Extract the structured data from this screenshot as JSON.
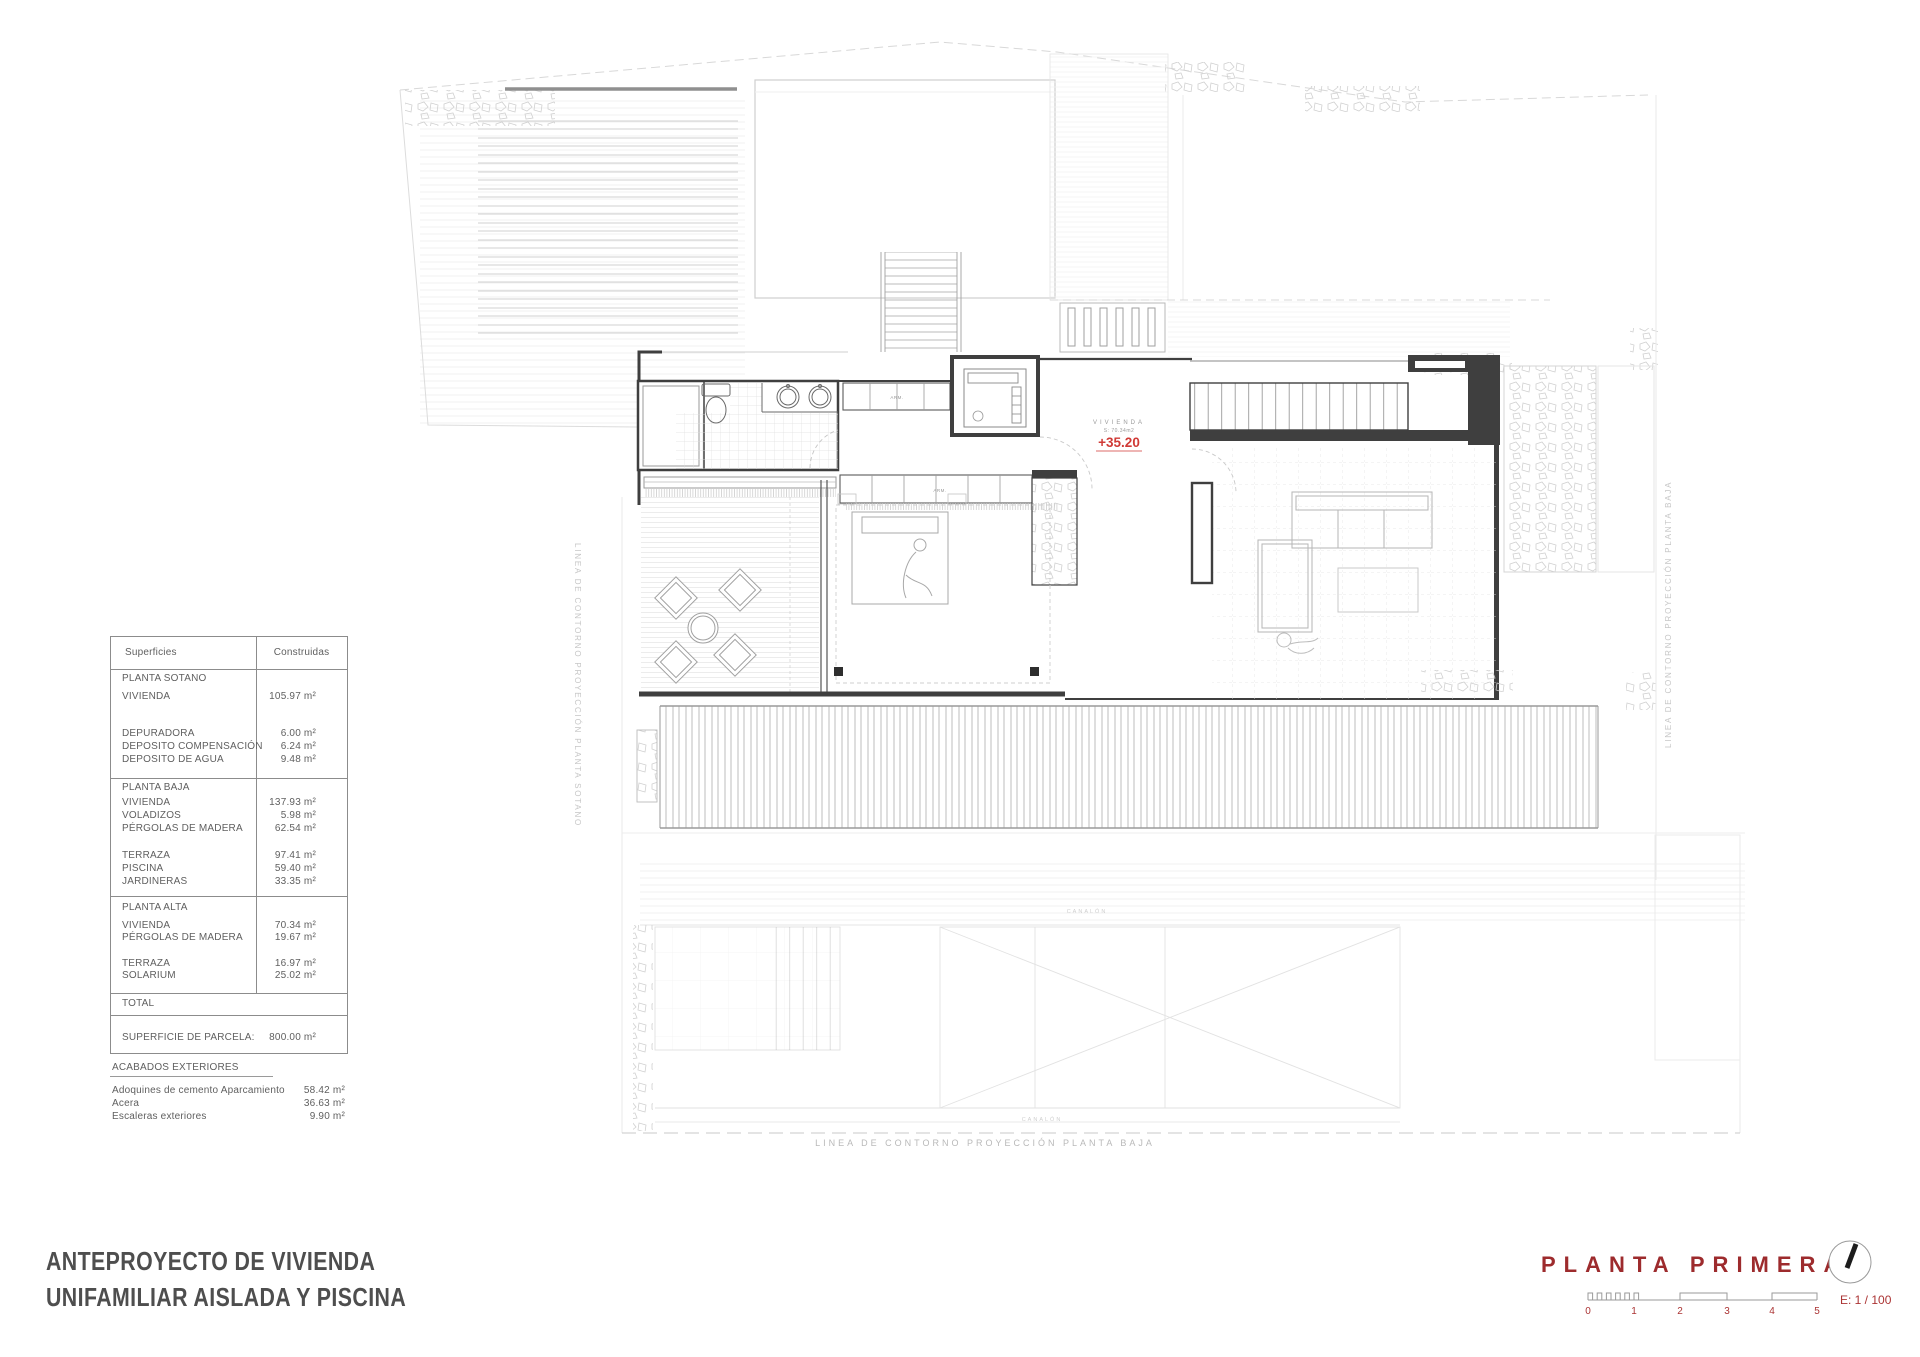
{
  "colors": {
    "accent_red": "#9d2b2d",
    "marker_red": "#d03a36",
    "plan_dark": "#3f3f3f",
    "plan_light": "#d8d8d8"
  },
  "surface_table": {
    "header_col1": "Superficies",
    "header_col2": "Construidas",
    "rows": [
      {
        "label": "PLANTA SOTANO",
        "value": ""
      },
      {
        "label": "VIVIENDA",
        "value": "105.97 m²"
      },
      {
        "label": "DEPURADORA",
        "value": "6.00 m²"
      },
      {
        "label": "DEPOSITO COMPENSACIÓN",
        "value": "6.24 m²"
      },
      {
        "label": "DEPOSITO DE AGUA",
        "value": "9.48 m²"
      },
      {
        "label": "PLANTA BAJA",
        "value": ""
      },
      {
        "label": "VIVIENDA",
        "value": "137.93 m²"
      },
      {
        "label": "VOLADIZOS",
        "value": "5.98 m²"
      },
      {
        "label": "PÉRGOLAS DE MADERA",
        "value": "62.54 m²"
      },
      {
        "label": "TERRAZA",
        "value": "97.41 m²"
      },
      {
        "label": "PISCINA",
        "value": "59.40 m²"
      },
      {
        "label": "JARDINERAS",
        "value": "33.35 m²"
      },
      {
        "label": "PLANTA ALTA",
        "value": ""
      },
      {
        "label": "VIVIENDA",
        "value": "70.34 m²"
      },
      {
        "label": "PÉRGOLAS DE MADERA",
        "value": "19.67 m²"
      },
      {
        "label": "TERRAZA",
        "value": "16.97 m²"
      },
      {
        "label": "SOLARIUM",
        "value": "25.02 m²"
      },
      {
        "label": "TOTAL",
        "value": ""
      },
      {
        "label": "SUPERFICIE DE PARCELA:",
        "value": "800.00 m²"
      }
    ]
  },
  "acabados": {
    "heading": "ACABADOS EXTERIORES",
    "rows": [
      {
        "label": "Adoquines de cemento Aparcamiento",
        "value": "58.42 m²"
      },
      {
        "label": "Acera",
        "value": "36.63 m²"
      },
      {
        "label": "Escaleras exteriores",
        "value": "9.90 m²"
      }
    ]
  },
  "title_block": {
    "line1": "ANTEPROYECTO DE VIVIENDA",
    "line2": "UNIFAMILIAR AISLADA Y PISCINA"
  },
  "sheet": {
    "name": "PLANTA PRIMERA",
    "scale_label": "E: 1 / 100",
    "tick0": "0",
    "tick1": "1",
    "tick2": "2",
    "tick3": "3",
    "tick4": "4",
    "tick5": "5"
  },
  "plan": {
    "level_marker": {
      "room": "VIVIENDA",
      "area": "S: 70.34m2",
      "level": "+35.20"
    },
    "contour_left": "LINEA DE CONTORNO PROYECCIÓN PLANTA SOTANO",
    "contour_right": "LINEA DE CONTORNO PROYECCIÓN PLANTA BAJA",
    "contour_bottom": "LINEA DE CONTORNO PROYECCIÓN PLANTA BAJA",
    "gutter_top": "CANALÓN",
    "gutter_bottom": "CANALÓN",
    "wardrobe_top": "ARM.",
    "wardrobe_bottom": "ARM."
  }
}
